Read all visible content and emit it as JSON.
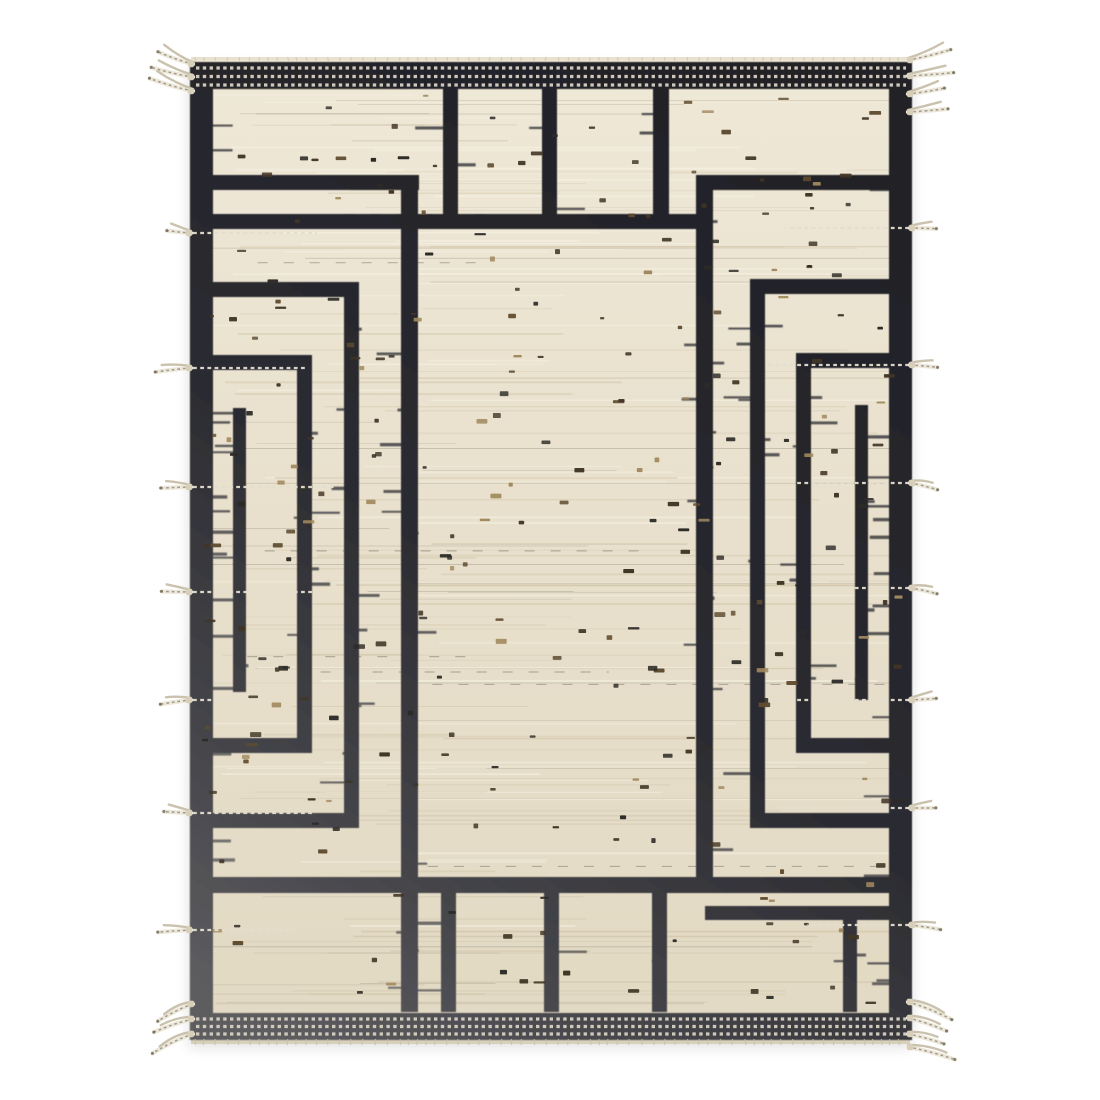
{
  "meta": {
    "subject": "handwoven flatweave rug, cream field with charcoal geometric bracket maze pattern, dotted end borders and side tassels",
    "orientation": "portrait rug centered on white background"
  },
  "canvas": {
    "width": 1100,
    "height": 1100,
    "background": "#ffffff"
  },
  "rug": {
    "x": 189,
    "y": 60,
    "width": 723,
    "height": 980
  },
  "palette": {
    "background": "#ffffff",
    "cream_top": "#efe8d7",
    "cream_mid": "#e8e0cc",
    "cream_bottom": "#e2d9c3",
    "ink_dark": "#202026",
    "ink_mid": "#2b2b31",
    "ink_faded": "#5d5d60",
    "dot_row": "#d6d0c2",
    "selvage_light": "#e8e1cd",
    "selvage_dark": "#d8d0bb",
    "weft_thread": "#e3decf",
    "tassel_light": "#ece7d8",
    "tassel_shade": "#c4bba4",
    "tassel_knot": "#d7cfba",
    "streak_warm": "#cdbfa2",
    "streak_light": "#f6f1e3",
    "streak_gray": "#6b6455",
    "streak_darkthread": "#3a362e",
    "speckle_colors": [
      "#413525",
      "#2d2b27",
      "#5f4c30",
      "#a28a5f"
    ]
  },
  "border": {
    "left_band": {
      "x": 190,
      "y": 62,
      "w": 23,
      "h": 978
    },
    "right_band": {
      "x": 889,
      "y": 62,
      "w": 23,
      "h": 978
    },
    "top_band": {
      "x": 190,
      "y": 62,
      "w": 722,
      "h": 27
    },
    "bottom_band": {
      "x": 190,
      "y": 1013,
      "w": 722,
      "h": 27
    },
    "top_dot_rows_y": [
      68,
      76.5,
      85
    ],
    "bottom_dot_rows_y": [
      1019,
      1026.5,
      1034
    ],
    "dot_row_x1": 196,
    "dot_row_x2": 906,
    "dot_dash": 3.4,
    "dot_gap": 3.4,
    "dot_width": 3.2
  },
  "pattern": {
    "bar_thickness": 15,
    "bars": [
      {
        "name": "left-arm-1",
        "x": 212,
        "y": 175,
        "w": 207,
        "h": 15
      },
      {
        "name": "right-arm-1",
        "x": 696,
        "y": 175,
        "w": 193,
        "h": 15
      },
      {
        "name": "center-horizontal",
        "x": 212,
        "y": 214,
        "w": 499,
        "h": 15
      },
      {
        "name": "left-vertical-1",
        "x": 401,
        "y": 175,
        "w": 17,
        "h": 837
      },
      {
        "name": "right-vertical-1",
        "x": 696,
        "y": 175,
        "w": 17,
        "h": 712
      },
      {
        "name": "left-arm-2-top",
        "x": 212,
        "y": 282,
        "w": 146,
        "h": 15
      },
      {
        "name": "left-vertical-2",
        "x": 344,
        "y": 282,
        "w": 15,
        "h": 546
      },
      {
        "name": "left-arm-2-bottom",
        "x": 212,
        "y": 813,
        "w": 146,
        "h": 15
      },
      {
        "name": "right-arm-2-top",
        "x": 750,
        "y": 279,
        "w": 139,
        "h": 15
      },
      {
        "name": "right-vertical-2",
        "x": 750,
        "y": 279,
        "w": 15,
        "h": 549
      },
      {
        "name": "right-arm-2-bottom",
        "x": 750,
        "y": 813,
        "w": 139,
        "h": 15
      },
      {
        "name": "left-arm-3-top",
        "x": 212,
        "y": 355,
        "w": 100,
        "h": 15
      },
      {
        "name": "left-vertical-3",
        "x": 297,
        "y": 355,
        "w": 15,
        "h": 398
      },
      {
        "name": "left-arm-3-bottom",
        "x": 212,
        "y": 738,
        "w": 100,
        "h": 15
      },
      {
        "name": "right-arm-3-top",
        "x": 796,
        "y": 353,
        "w": 93,
        "h": 15
      },
      {
        "name": "right-vertical-3",
        "x": 796,
        "y": 353,
        "w": 15,
        "h": 400
      },
      {
        "name": "right-arm-3-bottom",
        "x": 796,
        "y": 738,
        "w": 93,
        "h": 15
      },
      {
        "name": "left-inner-line",
        "x": 233,
        "y": 408,
        "w": 13,
        "h": 284
      },
      {
        "name": "right-inner-line",
        "x": 855,
        "y": 405,
        "w": 13,
        "h": 295
      },
      {
        "name": "top-vertical-a",
        "x": 443,
        "y": 88,
        "w": 15,
        "h": 133
      },
      {
        "name": "top-vertical-b",
        "x": 542,
        "y": 88,
        "w": 15,
        "h": 133
      },
      {
        "name": "top-vertical-c",
        "x": 653,
        "y": 88,
        "w": 16,
        "h": 133
      },
      {
        "name": "bottom-horizontal",
        "x": 212,
        "y": 877,
        "w": 677,
        "h": 16
      },
      {
        "name": "bottom-vertical-a",
        "x": 441,
        "y": 893,
        "w": 15,
        "h": 119
      },
      {
        "name": "bottom-vertical-b",
        "x": 544,
        "y": 893,
        "w": 15,
        "h": 119
      },
      {
        "name": "bottom-vertical-c",
        "x": 652,
        "y": 893,
        "w": 15,
        "h": 119
      },
      {
        "name": "bottom-right-bar",
        "x": 705,
        "y": 906,
        "w": 184,
        "h": 14
      },
      {
        "name": "bottom-right-vertical",
        "x": 843,
        "y": 916,
        "w": 14,
        "h": 96
      }
    ]
  },
  "tassels": {
    "left_ys": [
      233,
      368,
      487,
      592,
      700,
      813,
      930
    ],
    "right_ys": [
      228,
      365,
      483,
      588,
      700,
      808,
      925
    ],
    "corner_top_left_ys": [
      64,
      77,
      91
    ],
    "corner_top_right_ys": [
      60,
      76,
      94,
      112
    ],
    "corner_bottom_left_ys": [
      1004,
      1019,
      1034
    ],
    "corner_bottom_right_ys": [
      1002,
      1018,
      1034,
      1047
    ],
    "side_length_min": 24,
    "side_length_max": 36,
    "corner_length_min": 34,
    "corner_length_max": 48
  },
  "texture": {
    "streak_seed": 911,
    "streak_count": 175,
    "speckle_seed": 1234,
    "speckle_count": 265,
    "whisker_seed": 77,
    "band_whiskers_per_side": 13
  },
  "shadow": {
    "color": "#000000",
    "opacity": 0.13,
    "blur": 7,
    "offset_y": 7
  }
}
